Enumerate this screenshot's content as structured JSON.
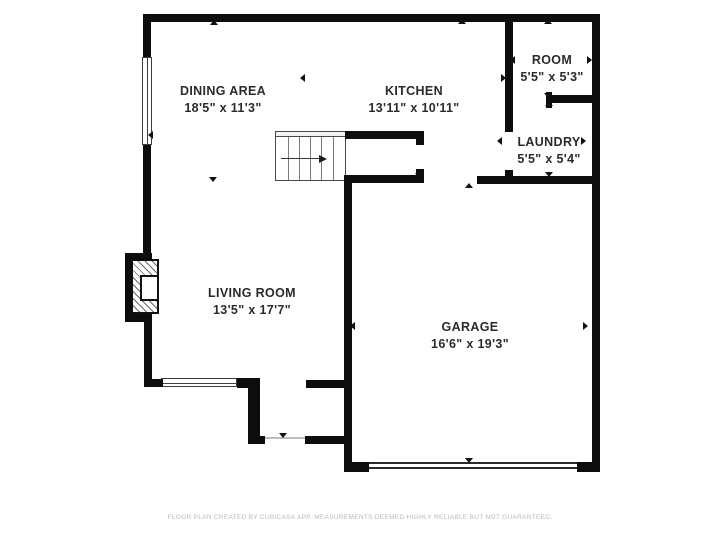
{
  "colors": {
    "wall": "#0d0d0d",
    "room_text": "#2b2b2b",
    "footer_text": "#b9b9b9",
    "background": "#ffffff"
  },
  "rooms": [
    {
      "id": "dining-area",
      "name": "DINING AREA",
      "dimensions": "18'5\" x 11'3\""
    },
    {
      "id": "kitchen",
      "name": "KITCHEN",
      "dimensions": "13'11\" x 10'11\""
    },
    {
      "id": "room",
      "name": "ROOM",
      "dimensions": "5'5\" x 5'3\""
    },
    {
      "id": "laundry",
      "name": "LAUNDRY",
      "dimensions": "5'5\" x 5'4\""
    },
    {
      "id": "living-room",
      "name": "LIVING ROOM",
      "dimensions": "13'5\" x 17'7\""
    },
    {
      "id": "garage",
      "name": "GARAGE",
      "dimensions": "16'6\" x 19'3\""
    }
  ],
  "footer": {
    "text": "FLOOR PLAN CREATED BY CUBICASA APP. MEASUREMENTS DEEMED HIGHLY RELIABLE BUT NOT GUARANTEED."
  },
  "plan": {
    "walls": [
      [
        143,
        14,
        457,
        8
      ],
      [
        143,
        14,
        8,
        43
      ],
      [
        143,
        145,
        8,
        116
      ],
      [
        125,
        253,
        27,
        8
      ],
      [
        125,
        253,
        8,
        69
      ],
      [
        125,
        314,
        27,
        8
      ],
      [
        144,
        314,
        8,
        73
      ],
      [
        144,
        379,
        19,
        8
      ],
      [
        237,
        378,
        23,
        10
      ],
      [
        248,
        380,
        12,
        64
      ],
      [
        248,
        436,
        17,
        8
      ],
      [
        305,
        436,
        47,
        8
      ],
      [
        306,
        380,
        39,
        8
      ],
      [
        344,
        175,
        8,
        297
      ],
      [
        344,
        462,
        25,
        10
      ],
      [
        577,
        462,
        23,
        10
      ],
      [
        592,
        14,
        8,
        458
      ],
      [
        345,
        131,
        79,
        8
      ],
      [
        416,
        131,
        8,
        14
      ],
      [
        345,
        175,
        79,
        8
      ],
      [
        416,
        169,
        8,
        14
      ],
      [
        477,
        176,
        123,
        8
      ],
      [
        505,
        14,
        8,
        118
      ],
      [
        505,
        170,
        8,
        14
      ],
      [
        546,
        92,
        6,
        16
      ],
      [
        549,
        95,
        43,
        8
      ]
    ],
    "windows": [
      {
        "x": 142,
        "y": 57,
        "w": 10,
        "h": 88,
        "orient": "v"
      },
      {
        "x": 161,
        "y": 378,
        "w": 76,
        "h": 9,
        "orient": "h"
      }
    ],
    "garage_door": {
      "x": 369,
      "y": 462,
      "w": 208,
      "h": 7
    },
    "front_door_threshold": {
      "x": 265,
      "y": 437,
      "w": 40,
      "h": 2
    },
    "stairs": {
      "x": 275,
      "y": 131,
      "w": 71,
      "h": 50,
      "treads": [
        12,
        23,
        34,
        45,
        57
      ],
      "arrow_x1": 5,
      "arrow_x2": 43,
      "arrow_y": 26
    },
    "fireplace": {
      "hatch": [
        131,
        259,
        28,
        55
      ],
      "inner": [
        140,
        275,
        19,
        26
      ]
    },
    "ticks": [
      [
        214,
        23,
        "up"
      ],
      [
        152,
        134,
        "left"
      ],
      [
        304,
        77,
        "left"
      ],
      [
        213,
        180,
        "down"
      ],
      [
        462,
        22,
        "up"
      ],
      [
        505,
        77,
        "right"
      ],
      [
        419,
        176,
        "down"
      ],
      [
        548,
        22,
        "up"
      ],
      [
        514,
        59,
        "left"
      ],
      [
        591,
        59,
        "right"
      ],
      [
        548,
        96,
        "down"
      ],
      [
        549,
        104,
        "up"
      ],
      [
        501,
        140,
        "left"
      ],
      [
        585,
        140,
        "right"
      ],
      [
        549,
        175,
        "down"
      ],
      [
        469,
        186,
        "up"
      ],
      [
        354,
        325,
        "left"
      ],
      [
        587,
        325,
        "right"
      ],
      [
        469,
        461,
        "down"
      ],
      [
        283,
        436,
        "down"
      ]
    ]
  }
}
